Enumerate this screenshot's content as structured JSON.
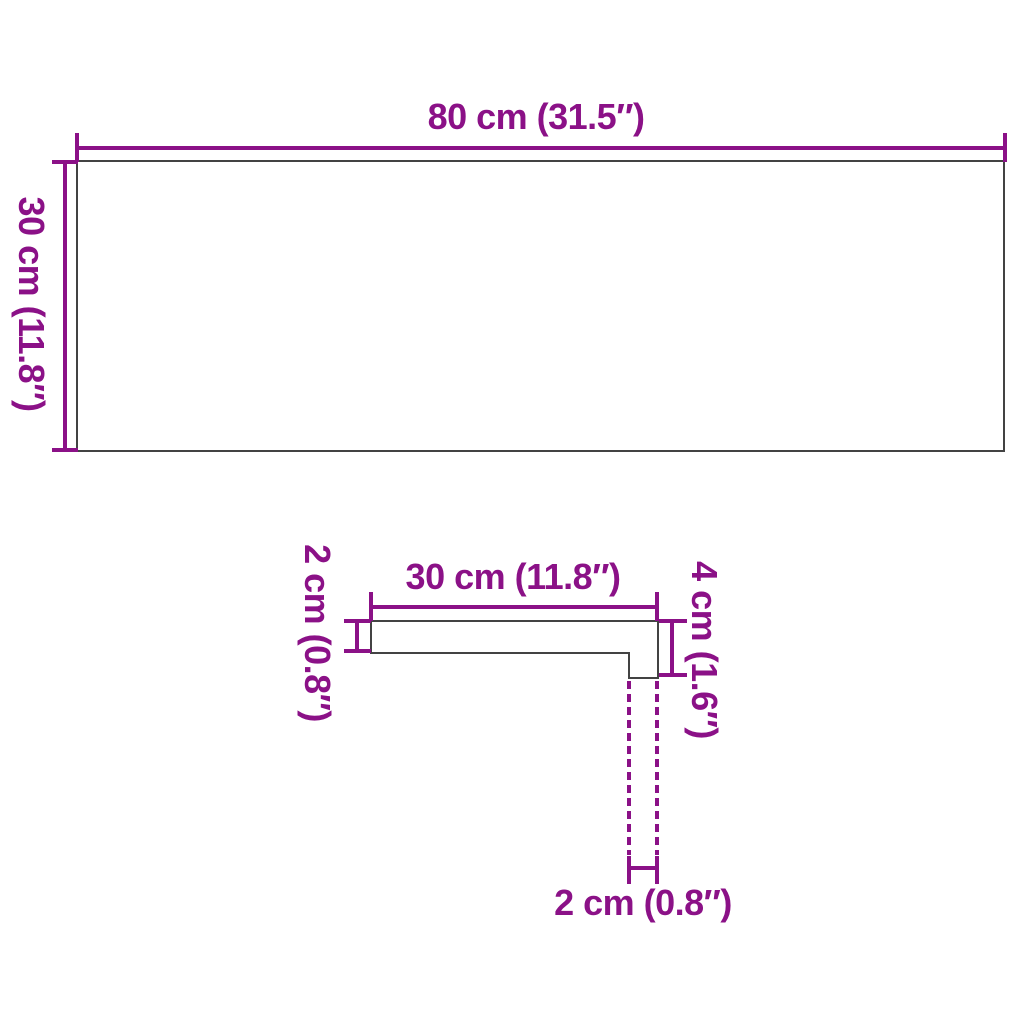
{
  "colors": {
    "accent": "#8B1187",
    "outline": "#434343",
    "background": "#ffffff"
  },
  "top_view": {
    "width_label": "80 cm (31.5″)",
    "height_label": "30 cm (11.8″)"
  },
  "side_profile": {
    "depth_label": "30 cm (11.8″)",
    "thickness_label": "2 cm (0.8″)",
    "nose_height_label": "4 cm (1.6″)",
    "nose_depth_label": "2 cm (0.8″)"
  }
}
